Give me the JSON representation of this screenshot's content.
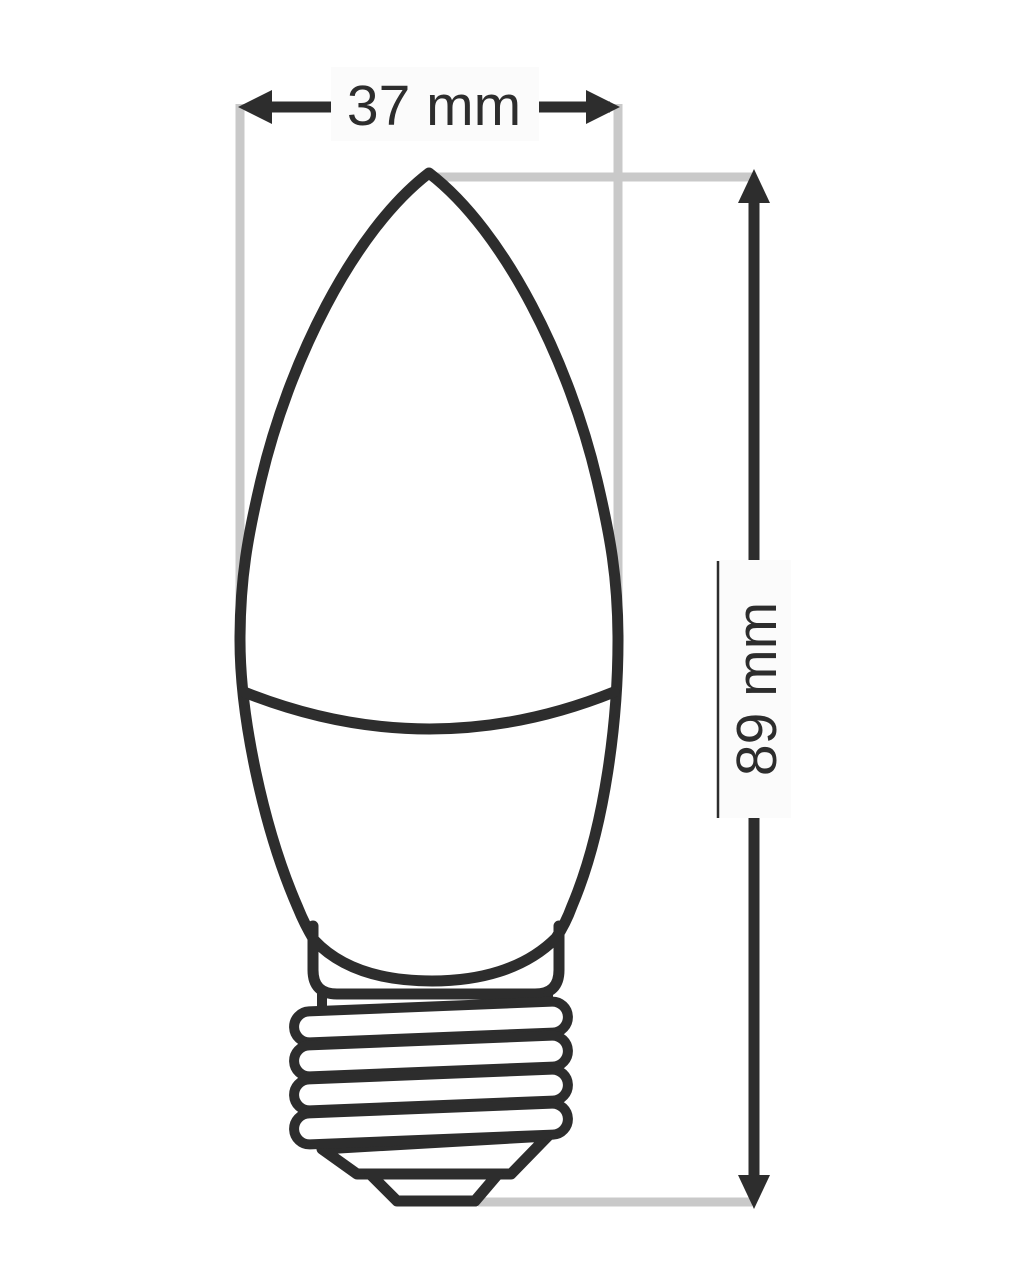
{
  "diagram": {
    "subject": "candle-bulb-outline-with-screw-base",
    "dimensions": {
      "width": {
        "label": "37 mm",
        "value": 37,
        "unit": "mm"
      },
      "height": {
        "label": "89 mm",
        "value": 89,
        "unit": "mm"
      }
    },
    "colors": {
      "outline": "#2d2d2d",
      "extension_line": "#c9c9c9",
      "label_background": "#fbfbfb",
      "text": "#2d2d2d",
      "background": "#ffffff"
    }
  }
}
